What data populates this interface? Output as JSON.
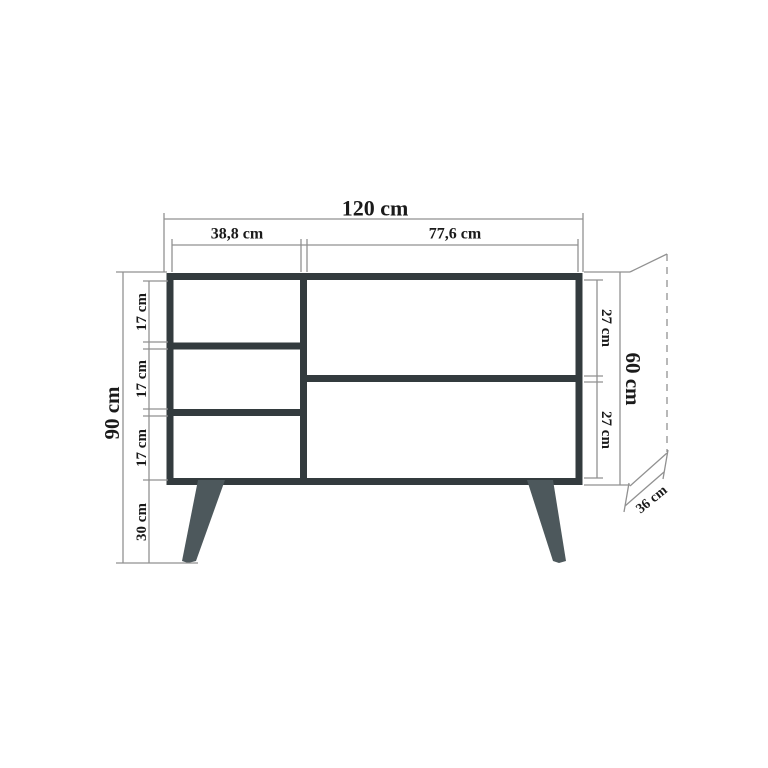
{
  "drawing": {
    "title": "sideboard-dimension-drawing",
    "view": "front elevation with depth projection",
    "labels": {
      "total_width": "120 cm",
      "left_column_width": "38,8 cm",
      "right_column_width": "77,6 cm",
      "total_height": "90 cm",
      "left_shelf_1_height": "17 cm",
      "left_shelf_2_height": "17 cm",
      "left_shelf_3_height": "17 cm",
      "leg_height": "30 cm",
      "right_shelf_1_height": "27 cm",
      "right_shelf_2_height": "27 cm",
      "body_height": "60 cm",
      "depth": "36 cm"
    },
    "colors": {
      "background": "#ffffff",
      "body_outline": "#333b3e",
      "legs": "#4d585c",
      "dimension_lines": "#919191",
      "label_text": "#1a1a1a"
    }
  }
}
